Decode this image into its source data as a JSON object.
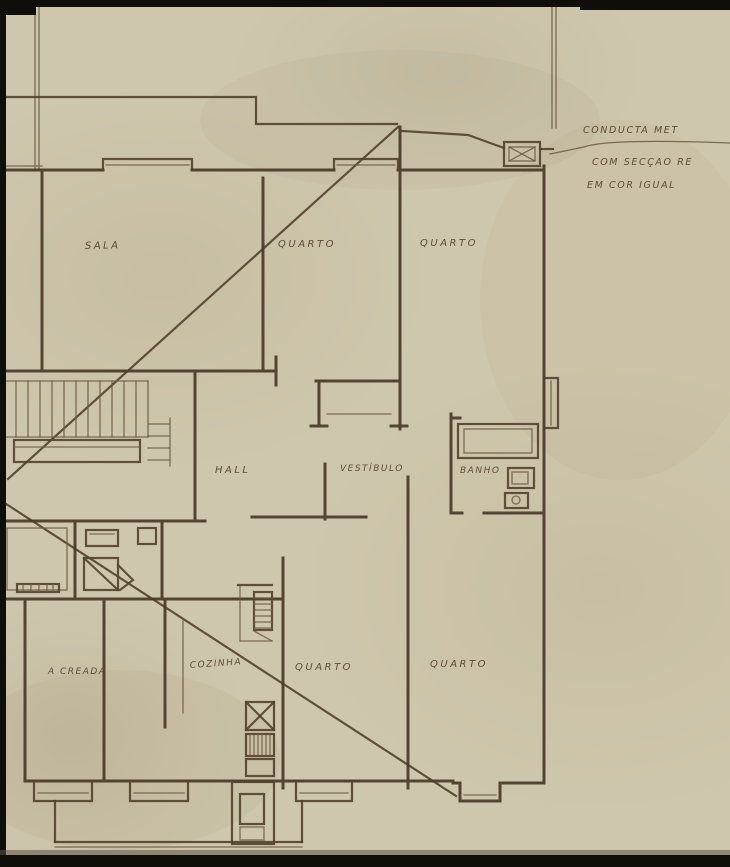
{
  "sheet": {
    "kind": "hand-drawn architectural floor plan",
    "language": "Portuguese"
  },
  "colors": {
    "paper": "#cfc7ad",
    "ink": "#4a3a28",
    "ink_thin": "#6b5a43",
    "scan_edge": "#100e09"
  },
  "rooms": {
    "sala": "SALA",
    "quarto_top_left": "QUARTO",
    "quarto_top_right": "QUARTO",
    "hall": "HALL",
    "vestibulo": "VESTÍBULO",
    "banho": "BANHO",
    "creada": "A CREADA",
    "cozinha": "COZINHA",
    "quarto_bottom_left": "QUARTO",
    "quarto_bottom_right": "QUARTO",
    "left_edge_fragment": "A"
  },
  "annotation": {
    "line1": "CONDUCTA MET",
    "line2": "COM SECÇÃO RE",
    "line3": "EM COR IGUAL"
  }
}
